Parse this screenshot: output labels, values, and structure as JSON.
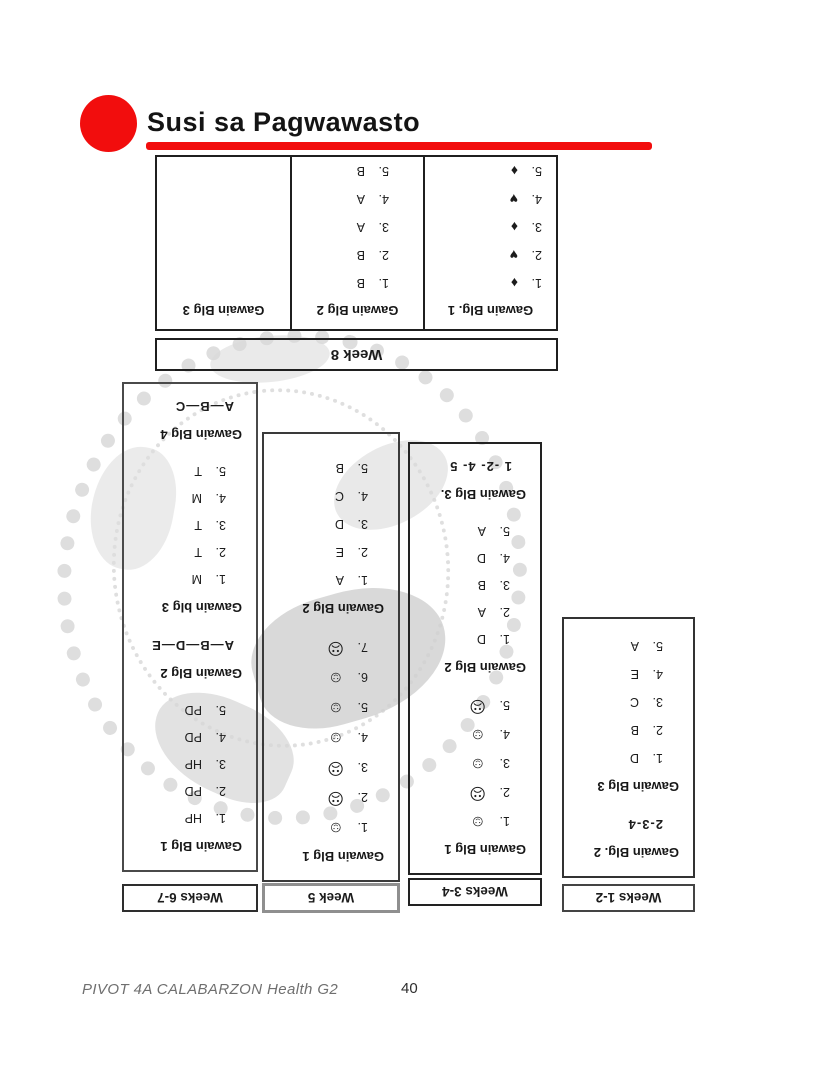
{
  "title": "Susi sa Pagwawasto",
  "colors": {
    "accent": "#f20d0d"
  },
  "footer": {
    "left": "PIVOT 4A CALABARZON Health G2",
    "page": "40"
  },
  "week8": {
    "label": "Week 8",
    "col1": {
      "header": "Gawain Blg. 1",
      "items": [
        {
          "n": "1.",
          "v": "♦"
        },
        {
          "n": "2.",
          "v": "♥"
        },
        {
          "n": "3.",
          "v": "♦"
        },
        {
          "n": "4.",
          "v": "♥"
        },
        {
          "n": "5.",
          "v": "♦"
        }
      ]
    },
    "col2": {
      "header": "Gawain Blg 2",
      "items": [
        {
          "n": "1.",
          "v": "B"
        },
        {
          "n": "2.",
          "v": "B"
        },
        {
          "n": "3.",
          "v": "A"
        },
        {
          "n": "4.",
          "v": "A"
        },
        {
          "n": "5.",
          "v": "B"
        }
      ]
    },
    "col3": {
      "header": "Gawain Blg 3"
    }
  },
  "weeks67": {
    "label": "Weeks 6-7",
    "h1": "Gawain Blg 1",
    "g1": [
      {
        "n": "1.",
        "v": "HP"
      },
      {
        "n": "2.",
        "v": "PD"
      },
      {
        "n": "3.",
        "v": "HP"
      },
      {
        "n": "4.",
        "v": "PD"
      },
      {
        "n": "5.",
        "v": "PD"
      }
    ],
    "h2": "Gawain Blg 2",
    "a2": "A—B—D—E",
    "h3": "Gawain blg 3",
    "g3": [
      {
        "n": "1.",
        "v": "M"
      },
      {
        "n": "2.",
        "v": "T"
      },
      {
        "n": "3.",
        "v": "T"
      },
      {
        "n": "4.",
        "v": "M"
      },
      {
        "n": "5.",
        "v": "T"
      }
    ],
    "h4": "Gawain Blg 4",
    "a4": "A—B—C"
  },
  "week5": {
    "label": "Week 5",
    "h1": "Gawain Blg 1",
    "g1": [
      {
        "n": "1.",
        "v": "☺"
      },
      {
        "n": "2.",
        "v": "☹"
      },
      {
        "n": "3.",
        "v": "☹"
      },
      {
        "n": "4.",
        "v": "☺"
      },
      {
        "n": "5.",
        "v": "☺"
      },
      {
        "n": "6.",
        "v": "☺"
      },
      {
        "n": "7.",
        "v": "☹"
      }
    ],
    "h2": "Gawain Blg 2",
    "g2": [
      {
        "n": "1.",
        "v": "A"
      },
      {
        "n": "2.",
        "v": "E"
      },
      {
        "n": "3.",
        "v": "D"
      },
      {
        "n": "4.",
        "v": "C"
      },
      {
        "n": "5.",
        "v": "B"
      }
    ]
  },
  "weeks34": {
    "label": "Weeks 3-4",
    "h1": "Gawain Blg 1",
    "g1": [
      {
        "n": "1.",
        "v": "☺"
      },
      {
        "n": "2.",
        "v": "☹"
      },
      {
        "n": "3.",
        "v": "☺"
      },
      {
        "n": "4.",
        "v": "☺"
      },
      {
        "n": "5.",
        "v": "☹"
      }
    ],
    "h2": "Gawain Blg 2",
    "g2": [
      {
        "n": "1.",
        "v": "D"
      },
      {
        "n": "2.",
        "v": "A"
      },
      {
        "n": "3.",
        "v": "B"
      },
      {
        "n": "4.",
        "v": "D"
      },
      {
        "n": "5.",
        "v": "A"
      }
    ],
    "h3": "Gawain Blg 3.",
    "a3": "1 -2- 4- 5"
  },
  "weeks12": {
    "label": "Weeks 1-2",
    "h2": "Gawain Blg. 2",
    "a2": "2-3-4",
    "h3": "Gawain Blg 3",
    "g3": [
      {
        "n": "1.",
        "v": "D"
      },
      {
        "n": "2.",
        "v": "B"
      },
      {
        "n": "3.",
        "v": "C"
      },
      {
        "n": "4.",
        "v": "E"
      },
      {
        "n": "5.",
        "v": "A"
      }
    ]
  }
}
